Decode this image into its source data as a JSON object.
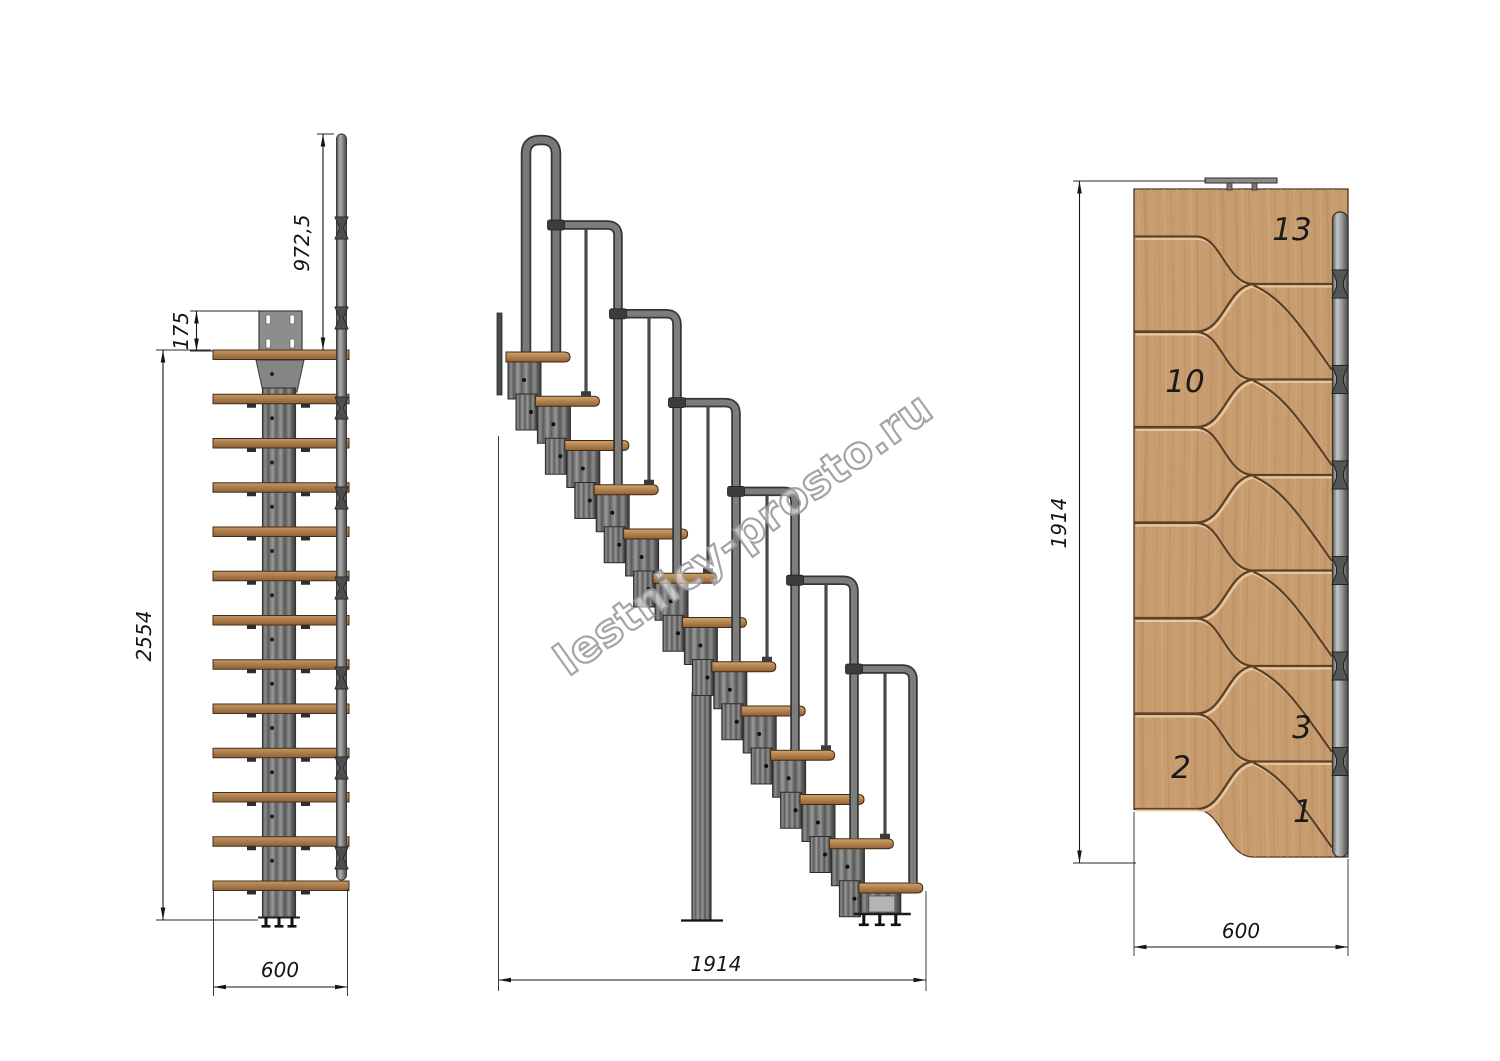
{
  "watermark": {
    "text": "lestnicy-prosto.ru"
  },
  "views": {
    "front": {
      "steps": 13,
      "dims": {
        "handrail_height": "972,5",
        "plate_offset": "175",
        "total_height": "2554",
        "width": "600"
      }
    },
    "side": {
      "steps": 13,
      "rails": 6,
      "dims": {
        "length": "1914"
      }
    },
    "plan": {
      "bands": 6,
      "tread_labels": [
        "13",
        "10",
        "3",
        "2",
        "1"
      ],
      "dims": {
        "length": "1914",
        "width": "600"
      }
    }
  },
  "colors": {
    "line": "#161616",
    "wood_light": "#cfa373",
    "wood_mid": "#b5854f",
    "wood_dark": "#8f6136",
    "plan_wood": "#c79c6f",
    "groove_dark": "#5a4127",
    "groove_light": "#ecc9a0",
    "metal_dark": "#3f3f3f",
    "metal_mid": "#7d807d",
    "metal_light": "#b9bcb9",
    "watermark_gray": "#959595"
  }
}
